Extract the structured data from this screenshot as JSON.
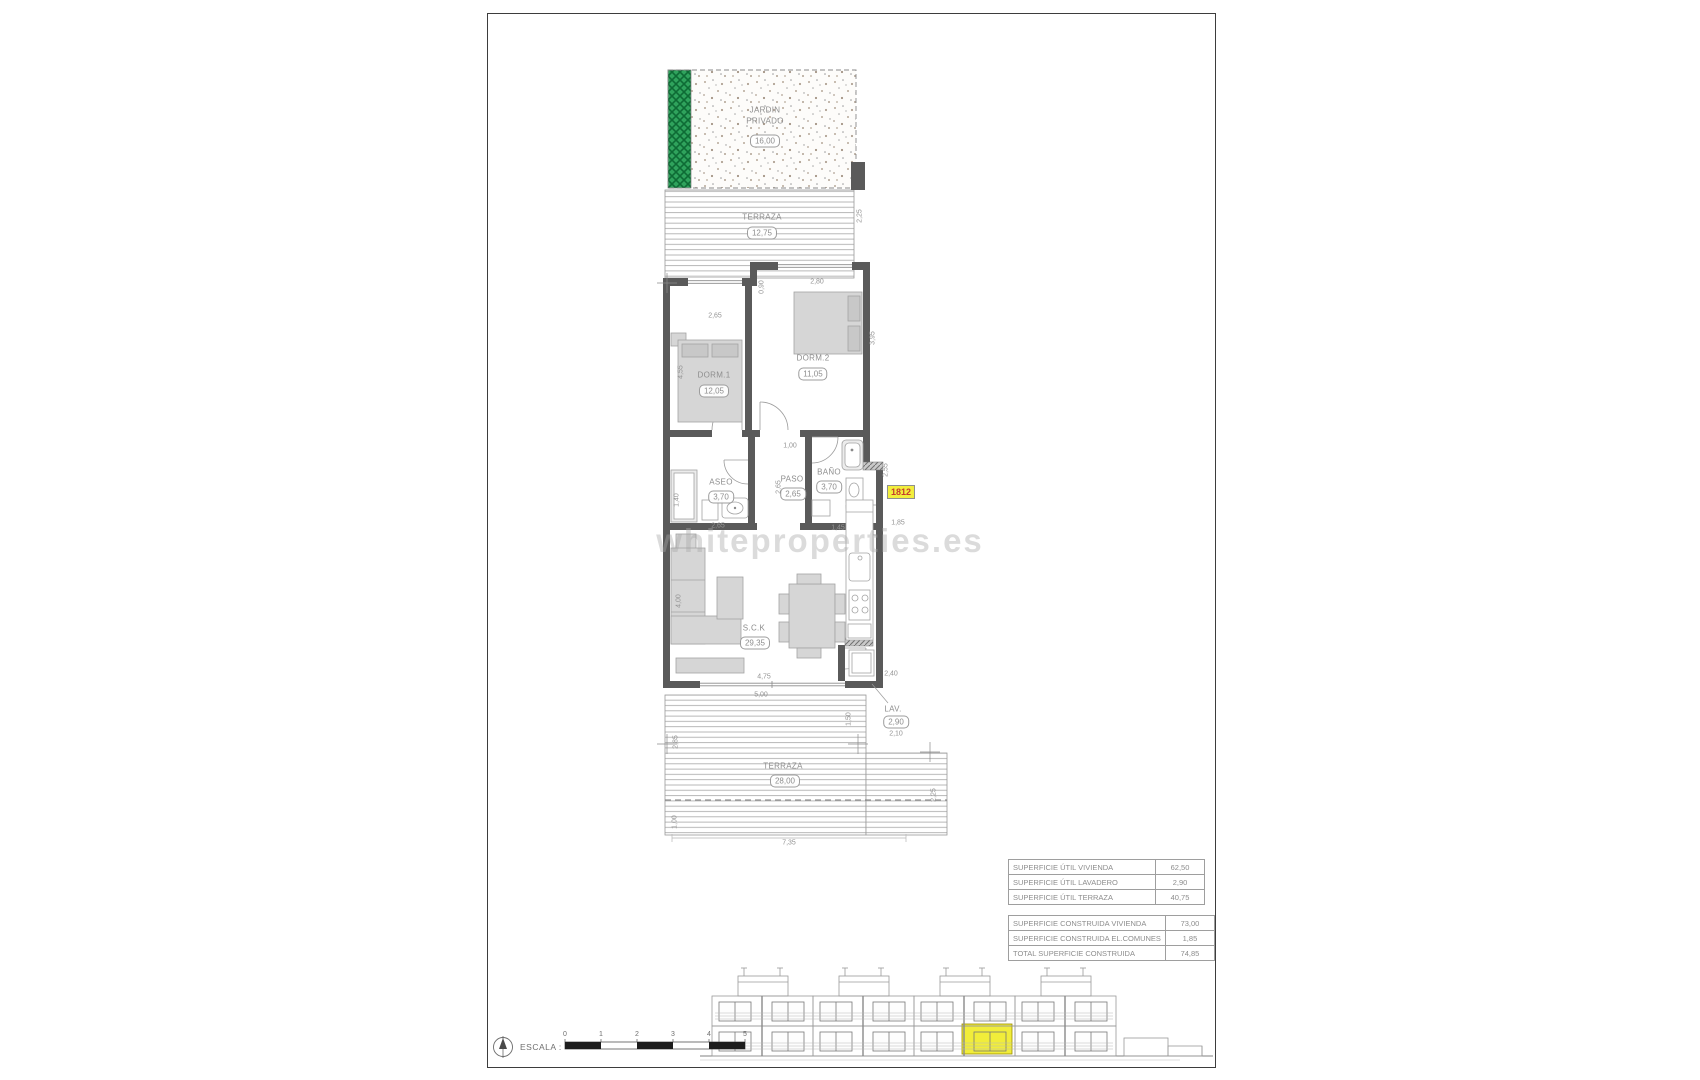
{
  "plan": {
    "garden": {
      "label1": "JARDIN",
      "label2": "PRIVADO",
      "area": "16,00"
    },
    "terrace_top": {
      "label": "TERRAZA",
      "area": "12,75"
    },
    "rooms": {
      "dorm1": {
        "label": "DORM.1",
        "area": "12,05"
      },
      "dorm2": {
        "label": "DORM.2",
        "area": "11,05"
      },
      "aseo": {
        "label": "ASEO",
        "area": "3,70"
      },
      "paso": {
        "label": "PASO",
        "area": "2,65"
      },
      "bano": {
        "label": "BAÑO",
        "area": "3,70"
      },
      "salon": {
        "label": "S.C.K",
        "area": "29,35"
      },
      "lav": {
        "label": "LAV.",
        "area": "2,90",
        "width": "2,10"
      },
      "terrace_bottom": {
        "label": "TERRAZA",
        "area": "28,00"
      }
    },
    "unit_tag": "1812",
    "dims": {
      "terrace_top_right": "2,25",
      "dorm1_window": "2,65",
      "step_depth": "0,90",
      "dorm2_window": "2,80",
      "dorm1_side": "4,55",
      "dorm2_side": "3,95",
      "paso_top": "1,00",
      "aseo_side": "1,40",
      "aseo_width": "2,65",
      "paso_depth": "2,65",
      "bano_width": "1,45",
      "bano_side": "2,55",
      "entry_side": "1,85",
      "living_side": "4,00",
      "living_width": "4,75",
      "living_right": "2,40",
      "terrace2_top": "5,00",
      "terrace2_left": "2,85",
      "terrace2_step": "1,50",
      "terrace2_bottom_left": "1,00",
      "terrace2_bottom": "7,35",
      "terrace2_right": "2,25"
    }
  },
  "summary": {
    "util": {
      "rows": [
        {
          "label": "SUPERFICIE ÚTIL VIVIENDA",
          "value": "62,50"
        },
        {
          "label": "SUPERFICIE ÚTIL LAVADERO",
          "value": "2,90"
        },
        {
          "label": "SUPERFICIE ÚTIL TERRAZA",
          "value": "40,75"
        }
      ]
    },
    "construida": {
      "rows": [
        {
          "label": "SUPERFICIE CONSTRUIDA VIVIENDA",
          "value": "73,00"
        },
        {
          "label": "SUPERFICIE CONSTRUIDA EL.COMUNES",
          "value": "1,85"
        },
        {
          "label": "TOTAL SUPERFICIE CONSTRUIDA",
          "value": "74,85"
        }
      ]
    }
  },
  "scale_bar": {
    "label": "ESCALA :",
    "ticks": [
      "0",
      "1",
      "2",
      "3",
      "4",
      "5"
    ]
  },
  "watermark": "whiteproperties.es"
}
